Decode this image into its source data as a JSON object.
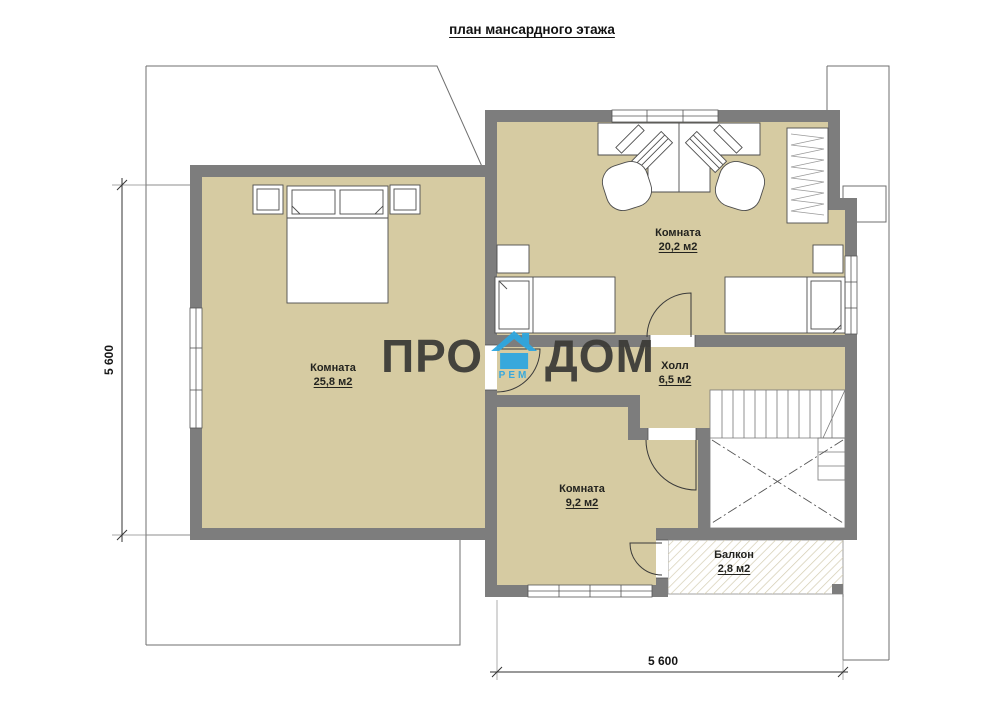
{
  "title": "план мансардного этажа",
  "rooms": [
    {
      "id": "bedroom-large",
      "name": "Комната",
      "area": "25,8 м2"
    },
    {
      "id": "bedroom-top",
      "name": "Комната",
      "area": "20,2 м2"
    },
    {
      "id": "hall",
      "name": "Холл",
      "area": "6,5 м2"
    },
    {
      "id": "bedroom-small",
      "name": "Комната",
      "area": "9,2 м2"
    },
    {
      "id": "balcony",
      "name": "Балкон",
      "area": "2,8 м2"
    }
  ],
  "dimensions": {
    "left": "5 600",
    "bottom": "5 600"
  },
  "logo": {
    "part1": "ПРО",
    "part2": "ДОМ",
    "subtext": "РЕМ"
  },
  "colors": {
    "floor": "#d6cba2",
    "wall": "#7d7d7d",
    "logo_blue": "#2fa7e0",
    "line": "#6f6f6f"
  }
}
